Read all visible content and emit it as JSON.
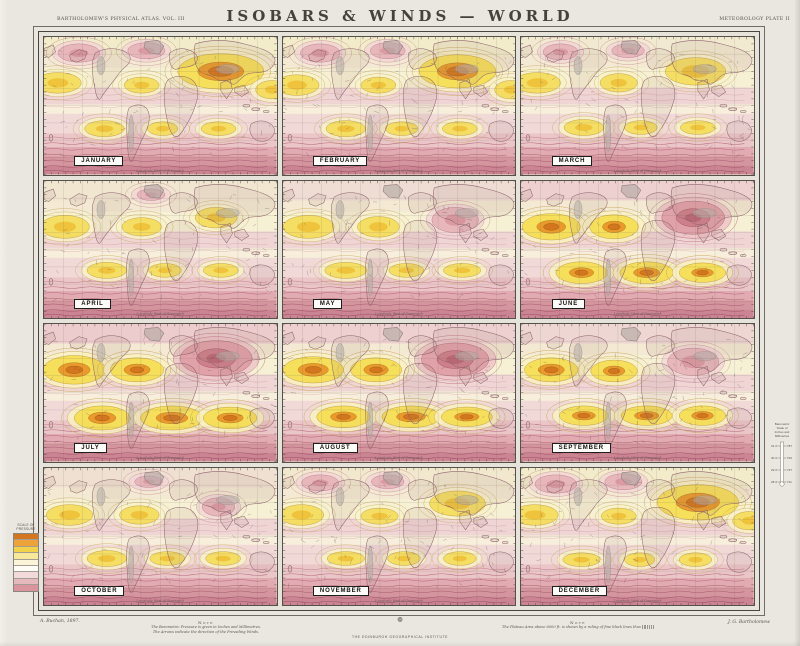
{
  "header": {
    "left": "BARTHOLOMEW'S PHYSICAL ATLAS. VOL. III",
    "title": "ISOBARS & WINDS — WORLD",
    "right": "METEOROLOGY  PLATE II"
  },
  "map_footer_note": "Longitude West of Greenwich",
  "months": [
    {
      "label": "JANUARY",
      "tint": "#f2ecca",
      "f": [
        {
          "k": "h2",
          "x": 152,
          "y": 30,
          "rx": 32,
          "ry": 13
        },
        {
          "k": "h1",
          "x": 12,
          "y": 40,
          "rx": 18,
          "ry": 8
        },
        {
          "k": "h1",
          "x": 196,
          "y": 46,
          "rx": 12,
          "ry": 7
        },
        {
          "k": "h1",
          "x": 84,
          "y": 42,
          "rx": 13,
          "ry": 6
        },
        {
          "k": "l1",
          "x": 30,
          "y": 14,
          "rx": 16,
          "ry": 7
        },
        {
          "k": "l1",
          "x": 88,
          "y": 12,
          "rx": 14,
          "ry": 6
        },
        {
          "k": "h1",
          "x": 52,
          "y": 80,
          "rx": 15,
          "ry": 6
        },
        {
          "k": "h1",
          "x": 102,
          "y": 80,
          "rx": 11,
          "ry": 5
        },
        {
          "k": "h1",
          "x": 150,
          "y": 80,
          "rx": 13,
          "ry": 5
        }
      ]
    },
    {
      "label": "FEBRUARY",
      "tint": "#f2ecca",
      "f": [
        {
          "k": "h2",
          "x": 150,
          "y": 30,
          "rx": 28,
          "ry": 12
        },
        {
          "k": "h1",
          "x": 12,
          "y": 42,
          "rx": 17,
          "ry": 8
        },
        {
          "k": "h1",
          "x": 196,
          "y": 46,
          "rx": 12,
          "ry": 7
        },
        {
          "k": "h1",
          "x": 82,
          "y": 42,
          "rx": 13,
          "ry": 6
        },
        {
          "k": "l1",
          "x": 32,
          "y": 14,
          "rx": 15,
          "ry": 7
        },
        {
          "k": "l1",
          "x": 90,
          "y": 12,
          "rx": 13,
          "ry": 6
        },
        {
          "k": "h1",
          "x": 54,
          "y": 80,
          "rx": 15,
          "ry": 6
        },
        {
          "k": "h1",
          "x": 102,
          "y": 80,
          "rx": 12,
          "ry": 5
        },
        {
          "k": "h1",
          "x": 152,
          "y": 80,
          "rx": 13,
          "ry": 5
        }
      ]
    },
    {
      "label": "MARCH",
      "tint": "#f2ead0",
      "f": [
        {
          "k": "h1",
          "x": 150,
          "y": 30,
          "rx": 24,
          "ry": 11
        },
        {
          "k": "h1",
          "x": 14,
          "y": 40,
          "rx": 18,
          "ry": 8
        },
        {
          "k": "h1",
          "x": 84,
          "y": 40,
          "rx": 14,
          "ry": 7
        },
        {
          "k": "l1",
          "x": 34,
          "y": 13,
          "rx": 13,
          "ry": 6
        },
        {
          "k": "l1",
          "x": 92,
          "y": 12,
          "rx": 12,
          "ry": 5
        },
        {
          "k": "h1",
          "x": 54,
          "y": 79,
          "rx": 15,
          "ry": 6
        },
        {
          "k": "h1",
          "x": 103,
          "y": 79,
          "rx": 12,
          "ry": 5
        },
        {
          "k": "h1",
          "x": 152,
          "y": 79,
          "rx": 13,
          "ry": 5
        }
      ]
    },
    {
      "label": "APRIL",
      "tint": "#f1e6d0",
      "f": [
        {
          "k": "h1",
          "x": 148,
          "y": 32,
          "rx": 16,
          "ry": 8
        },
        {
          "k": "h1",
          "x": 18,
          "y": 40,
          "rx": 19,
          "ry": 9
        },
        {
          "k": "h1",
          "x": 84,
          "y": 40,
          "rx": 15,
          "ry": 7
        },
        {
          "k": "l1",
          "x": 92,
          "y": 12,
          "rx": 10,
          "ry": 4
        },
        {
          "k": "h1",
          "x": 54,
          "y": 78,
          "rx": 15,
          "ry": 6
        },
        {
          "k": "h1",
          "x": 104,
          "y": 78,
          "rx": 12,
          "ry": 5
        },
        {
          "k": "h1",
          "x": 152,
          "y": 78,
          "rx": 13,
          "ry": 5
        }
      ]
    },
    {
      "label": "MAY",
      "tint": "#efdcd2",
      "f": [
        {
          "k": "l1",
          "x": 148,
          "y": 34,
          "rx": 18,
          "ry": 10
        },
        {
          "k": "h1",
          "x": 22,
          "y": 40,
          "rx": 20,
          "ry": 9
        },
        {
          "k": "h1",
          "x": 82,
          "y": 40,
          "rx": 16,
          "ry": 8
        },
        {
          "k": "h1",
          "x": 54,
          "y": 78,
          "rx": 16,
          "ry": 6
        },
        {
          "k": "h1",
          "x": 106,
          "y": 78,
          "rx": 13,
          "ry": 5
        },
        {
          "k": "h1",
          "x": 154,
          "y": 78,
          "rx": 14,
          "ry": 5
        }
      ]
    },
    {
      "label": "JUNE",
      "tint": "#edd0cf",
      "f": [
        {
          "k": "l2",
          "x": 148,
          "y": 32,
          "rx": 24,
          "ry": 13
        },
        {
          "k": "h2",
          "x": 26,
          "y": 40,
          "rx": 20,
          "ry": 9
        },
        {
          "k": "h2",
          "x": 80,
          "y": 40,
          "rx": 16,
          "ry": 8
        },
        {
          "k": "h2",
          "x": 52,
          "y": 80,
          "rx": 17,
          "ry": 7
        },
        {
          "k": "h2",
          "x": 108,
          "y": 80,
          "rx": 18,
          "ry": 7
        },
        {
          "k": "h2",
          "x": 156,
          "y": 80,
          "rx": 15,
          "ry": 6
        }
      ]
    },
    {
      "label": "JULY",
      "tint": "#eccccc",
      "f": [
        {
          "k": "l2",
          "x": 148,
          "y": 30,
          "rx": 28,
          "ry": 14
        },
        {
          "k": "h2",
          "x": 26,
          "y": 40,
          "rx": 22,
          "ry": 10
        },
        {
          "k": "h2",
          "x": 80,
          "y": 40,
          "rx": 18,
          "ry": 8
        },
        {
          "k": "h2",
          "x": 50,
          "y": 82,
          "rx": 19,
          "ry": 8
        },
        {
          "k": "h2",
          "x": 110,
          "y": 82,
          "rx": 22,
          "ry": 8
        },
        {
          "k": "h2",
          "x": 160,
          "y": 82,
          "rx": 18,
          "ry": 7
        }
      ]
    },
    {
      "label": "AUGUST",
      "tint": "#edd0cf",
      "f": [
        {
          "k": "l2",
          "x": 148,
          "y": 31,
          "rx": 26,
          "ry": 13
        },
        {
          "k": "h2",
          "x": 26,
          "y": 40,
          "rx": 21,
          "ry": 9
        },
        {
          "k": "h2",
          "x": 80,
          "y": 40,
          "rx": 17,
          "ry": 8
        },
        {
          "k": "h2",
          "x": 52,
          "y": 81,
          "rx": 18,
          "ry": 7
        },
        {
          "k": "h2",
          "x": 110,
          "y": 81,
          "rx": 20,
          "ry": 7
        },
        {
          "k": "h2",
          "x": 158,
          "y": 81,
          "rx": 17,
          "ry": 6
        }
      ]
    },
    {
      "label": "SEPTEMBER",
      "tint": "#eed6d2",
      "f": [
        {
          "k": "l1",
          "x": 148,
          "y": 33,
          "rx": 20,
          "ry": 11
        },
        {
          "k": "h2",
          "x": 26,
          "y": 40,
          "rx": 18,
          "ry": 8
        },
        {
          "k": "h2",
          "x": 80,
          "y": 41,
          "rx": 15,
          "ry": 7
        },
        {
          "k": "h2",
          "x": 54,
          "y": 80,
          "rx": 16,
          "ry": 6
        },
        {
          "k": "h2",
          "x": 108,
          "y": 80,
          "rx": 17,
          "ry": 6
        },
        {
          "k": "h2",
          "x": 156,
          "y": 80,
          "rx": 15,
          "ry": 6
        }
      ]
    },
    {
      "label": "OCTOBER",
      "tint": "#f0e0d2",
      "f": [
        {
          "k": "l1",
          "x": 150,
          "y": 34,
          "rx": 12,
          "ry": 7
        },
        {
          "k": "h1",
          "x": 22,
          "y": 41,
          "rx": 18,
          "ry": 8
        },
        {
          "k": "h1",
          "x": 82,
          "y": 41,
          "rx": 15,
          "ry": 7
        },
        {
          "k": "l1",
          "x": 90,
          "y": 12,
          "rx": 10,
          "ry": 4
        },
        {
          "k": "h1",
          "x": 54,
          "y": 79,
          "rx": 15,
          "ry": 6
        },
        {
          "k": "h1",
          "x": 106,
          "y": 79,
          "rx": 13,
          "ry": 5
        },
        {
          "k": "h1",
          "x": 154,
          "y": 79,
          "rx": 13,
          "ry": 5
        }
      ]
    },
    {
      "label": "NOVEMBER",
      "tint": "#f2e8ce",
      "f": [
        {
          "k": "h1",
          "x": 150,
          "y": 31,
          "rx": 22,
          "ry": 10
        },
        {
          "k": "h1",
          "x": 16,
          "y": 41,
          "rx": 17,
          "ry": 8
        },
        {
          "k": "h1",
          "x": 83,
          "y": 42,
          "rx": 14,
          "ry": 6
        },
        {
          "k": "l1",
          "x": 32,
          "y": 13,
          "rx": 14,
          "ry": 6
        },
        {
          "k": "l1",
          "x": 90,
          "y": 12,
          "rx": 12,
          "ry": 5
        },
        {
          "k": "h1",
          "x": 54,
          "y": 79,
          "rx": 14,
          "ry": 5
        },
        {
          "k": "h1",
          "x": 104,
          "y": 79,
          "rx": 12,
          "ry": 5
        },
        {
          "k": "h1",
          "x": 152,
          "y": 79,
          "rx": 12,
          "ry": 5
        }
      ]
    },
    {
      "label": "DECEMBER",
      "tint": "#f2ecca",
      "f": [
        {
          "k": "h2",
          "x": 152,
          "y": 30,
          "rx": 30,
          "ry": 13
        },
        {
          "k": "h1",
          "x": 12,
          "y": 41,
          "rx": 18,
          "ry": 8
        },
        {
          "k": "h1",
          "x": 196,
          "y": 46,
          "rx": 12,
          "ry": 7
        },
        {
          "k": "h1",
          "x": 84,
          "y": 42,
          "rx": 13,
          "ry": 6
        },
        {
          "k": "l1",
          "x": 30,
          "y": 14,
          "rx": 16,
          "ry": 7
        },
        {
          "k": "l1",
          "x": 88,
          "y": 12,
          "rx": 14,
          "ry": 6
        },
        {
          "k": "h1",
          "x": 52,
          "y": 80,
          "rx": 14,
          "ry": 5
        },
        {
          "k": "h1",
          "x": 102,
          "y": 80,
          "rx": 11,
          "ry": 5
        },
        {
          "k": "h1",
          "x": 150,
          "y": 80,
          "rx": 12,
          "ry": 5
        }
      ]
    }
  ],
  "legend": {
    "title_line1": "SCALE OF",
    "title_line2": "PRESSURE",
    "swatches": [
      "#d3761d",
      "#eda33a",
      "#f2d24a",
      "#f7e89a",
      "#fbf4d8",
      "#fdfcf5",
      "#f2dada",
      "#e6b9bd",
      "#d9949e"
    ]
  },
  "barometer": {
    "title_lines": [
      "Barometric",
      "Scale of",
      "Inches and",
      "Millimetres"
    ],
    "inches": [
      "31·0",
      "30·0",
      "29·0",
      "28·0"
    ],
    "millimetres": [
      "787",
      "762",
      "737",
      "711"
    ]
  },
  "footer": {
    "credit_left": "A. Buchan, 1897.",
    "note_left": {
      "heading": "Note",
      "lines": [
        "The Barometric Pressure is given in Inches and Millimetres.",
        "The Arrows indicate the direction of the Prevailing Winds."
      ]
    },
    "imprint": "THE EDINBURGH GEOGRAPHICAL INSTITUTE",
    "note_right": {
      "heading": "Note",
      "line": "The Plateau Area above 6000 ft. is shown by a ruling of fine black lines thus"
    },
    "credit_right": "J. G. Bartholomew"
  },
  "colors": {
    "paper": "#eae7e0",
    "frame": "#4a453e",
    "high_yellow": "#f3d84a",
    "high_orange": "#d3761d",
    "low_pink": "#dd9fa4",
    "south_band_red": "#ca8390"
  }
}
